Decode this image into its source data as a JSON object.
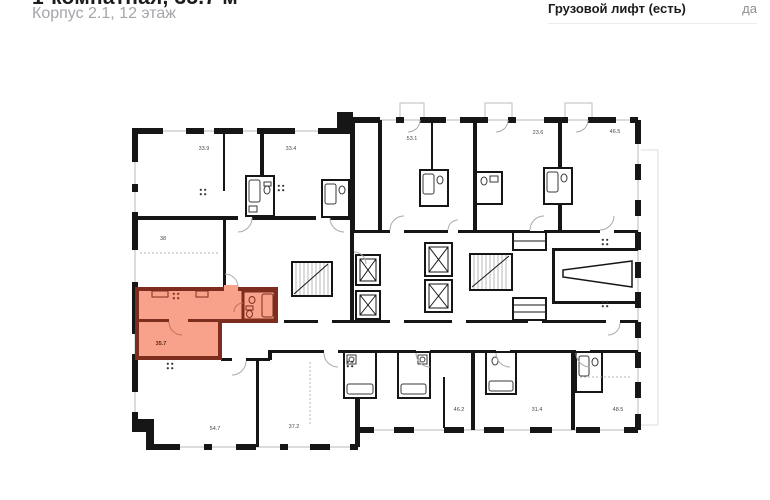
{
  "header": {
    "title": "1-комнатная, 35.7 м²",
    "subtitle": "Корпус 2.1, 12 этаж"
  },
  "specs": {
    "rows": [
      {
        "label": "Грузовой лифт (есть)",
        "value": "да"
      }
    ]
  },
  "plan": {
    "highlight": {
      "area": "35.7"
    },
    "units": [
      {
        "area": "33.9",
        "x": 204,
        "y": 150,
        "highlight": false
      },
      {
        "area": "33.4",
        "x": 291,
        "y": 150,
        "highlight": false
      },
      {
        "area": "53.1",
        "x": 412,
        "y": 140,
        "highlight": false
      },
      {
        "area": "23.6",
        "x": 538,
        "y": 134,
        "highlight": false
      },
      {
        "area": "46.5",
        "x": 615,
        "y": 133,
        "highlight": false
      },
      {
        "area": "38",
        "x": 163,
        "y": 240,
        "highlight": false
      },
      {
        "area": "35.7",
        "x": 161,
        "y": 345,
        "highlight": true
      },
      {
        "area": "54.7",
        "x": 215,
        "y": 430,
        "highlight": false
      },
      {
        "area": "37.2",
        "x": 294,
        "y": 428,
        "highlight": false
      },
      {
        "area": "46.2",
        "x": 459,
        "y": 411,
        "highlight": false
      },
      {
        "area": "31.4",
        "x": 537,
        "y": 411,
        "highlight": false
      },
      {
        "area": "48.5",
        "x": 618,
        "y": 411,
        "highlight": false
      }
    ],
    "colors": {
      "highlight_fill": "#f8a28c",
      "highlight_wall": "#7c2d1d",
      "highlight_text": "#5e2415",
      "wall": "#161616"
    }
  }
}
